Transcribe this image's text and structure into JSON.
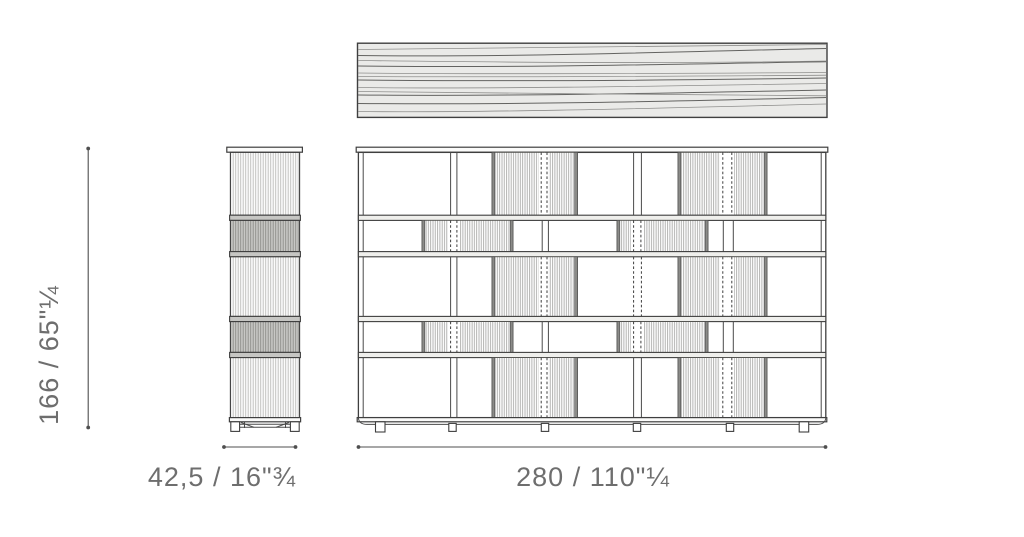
{
  "drawing": {
    "title": "bookcase-dimension-drawing",
    "height_dimension": "166 / 65\"¼",
    "depth_dimension": "42,5 / 16\"¾",
    "width_dimension": "280 / 110\"¼"
  },
  "colors": {
    "background": "#ffffff",
    "outline": "#3f3f3f",
    "dimension_line": "#4f4f4f",
    "label_text": "#6e6e6e",
    "top_panel_fill": "#eaeae8",
    "dark_slat_fill": "#c8c8c5",
    "panel_edge": "#8b8b88"
  }
}
